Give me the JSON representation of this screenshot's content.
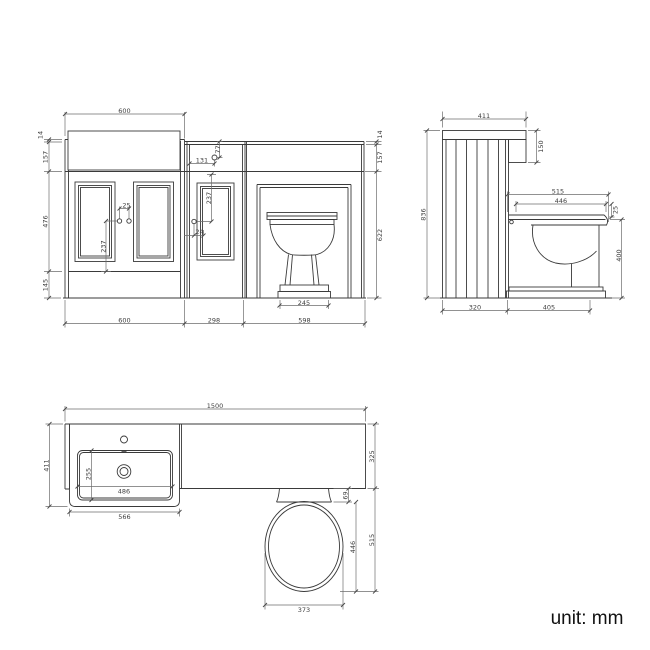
{
  "unit_label": "unit: mm",
  "colors": {
    "line": "#3a3a3a",
    "dimension": "#6e6e6e",
    "background": "#ffffff"
  },
  "front_dims": {
    "width_top": "600",
    "worktop_lip_left": "14",
    "upstand_left": "157",
    "door_height": "476",
    "plinth_height": "145",
    "knob_spacing": "25",
    "vanity_knob_from_bottom": "237",
    "flush_from_left": "131",
    "flush_from_top": "77",
    "wc_knob_from_top": "237",
    "wc_knob_offset": "24",
    "pan_base_width": "245",
    "width_vanity": "600",
    "width_wc": "298",
    "width_toilet": "598",
    "worktop_lip_right": "14",
    "upstand_right": "157",
    "body_height": "622"
  },
  "side_dims": {
    "depth_top": "411",
    "end_panel_drop": "150",
    "total_height": "836",
    "pan_projection": "515",
    "seat_length": "446",
    "seat_thickness": "25",
    "seat_height": "400",
    "unit_depth": "320",
    "pan_depth": "405"
  },
  "plan_dims": {
    "total_width": "1500",
    "vanity_depth": "411",
    "counter_depth": "325",
    "basin_bowl_depth": "255",
    "basin_bowl_width": "486",
    "basin_width": "566",
    "seat_gap": "69",
    "seat_length": "446",
    "pan_projection": "515",
    "pan_width": "373"
  }
}
